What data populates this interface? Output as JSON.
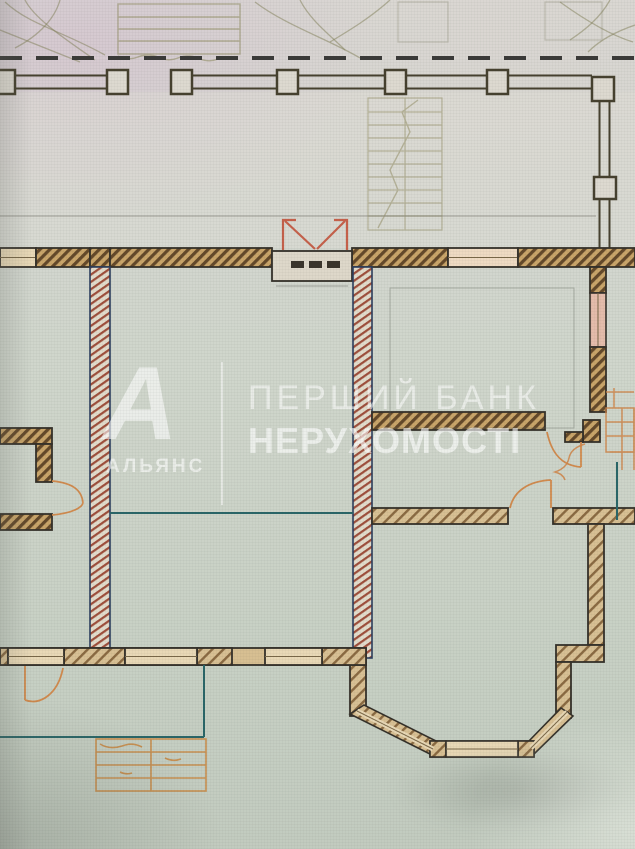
{
  "watermark": {
    "logo_letter": "А",
    "logo_caption": "АЛЬЯНС",
    "title_line1": "ПЕРШИЙ БАНК",
    "title_line2": "НЕРУХОМОСТІ",
    "text_color": "#ffffff"
  },
  "colors": {
    "paper_top": "#d9d8d4",
    "paper_main": "#ccd3c8",
    "wall_outline": "#35312a",
    "exterior_wall_hatch": "#64492a",
    "exterior_wall_fill": "#c9a56a",
    "light_wall_fill": "#d8c094",
    "interior_wall_edge": "#2c3e5e",
    "interior_wall_hatch": "#9e4f3c",
    "window_fill": "#e8d8b6",
    "window_pink_fill": "#e4bcab",
    "annotation_teal": "#2a6668",
    "door_swing_orange": "#d08a4e",
    "entrance_door_red": "#c5614b",
    "sketch_olive": "#8f8a5f"
  }
}
